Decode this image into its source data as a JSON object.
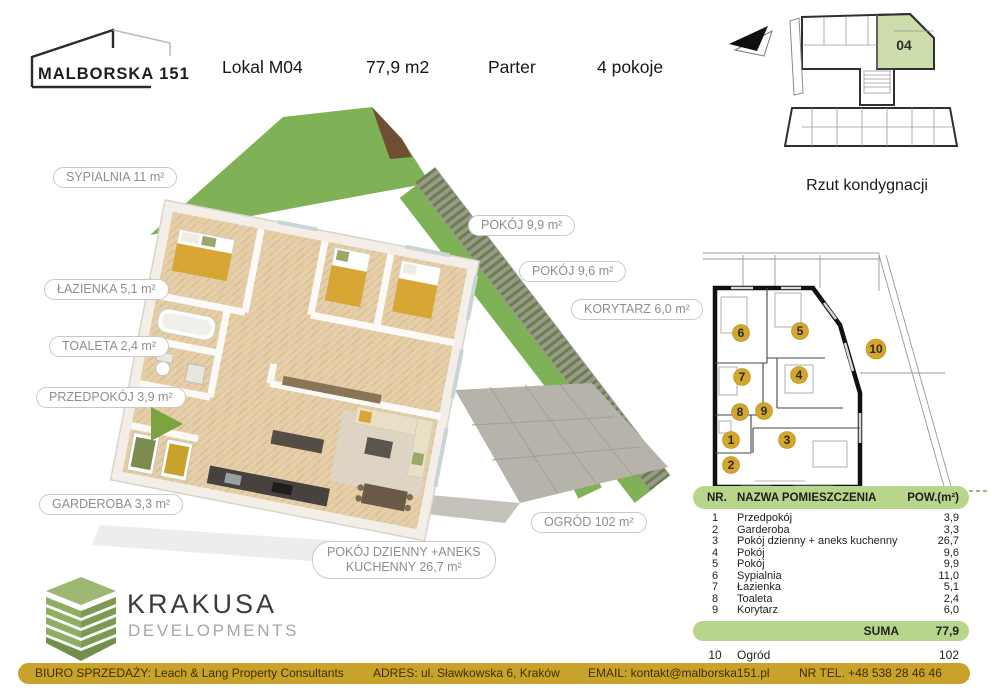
{
  "header": {
    "logo_title": "MALBORSKA 151",
    "items": [
      "Lokal M04",
      "77,9 m2",
      "Parter",
      "4 pokoje"
    ]
  },
  "key_plan": {
    "unit_label": "04",
    "caption": "Rzut kondygnacji"
  },
  "room_labels": {
    "sypialnia": "SYPIALNIA  11 m²",
    "pokoj_99": "POKÓJ  9,9 m²",
    "pokoj_96": "POKÓJ  9,6 m²",
    "korytarz": "KORYTARZ 6,0 m²",
    "lazienka": "ŁAZIENKA 5,1 m²",
    "toaleta": "TOALETA 2,4 m²",
    "przedpokoj": "PRZEDPOKÓJ  3,9 m²",
    "garderoba": "GARDEROBA  3,3 m²",
    "ogrod": "OGRÓD   102 m²",
    "pokoj_dzienny_line1": "POKÓJ DZIENNY +ANEKS",
    "pokoj_dzienny_line2": "KUCHENNY 26,7 m²"
  },
  "plan2d": {
    "markers": [
      "1",
      "2",
      "3",
      "4",
      "5",
      "6",
      "7",
      "8",
      "9",
      "10"
    ]
  },
  "table": {
    "headers": {
      "nr": "NR.",
      "name": "NAZWA POMIESZCZENIA",
      "area": "POW.(m²)"
    },
    "rows": [
      {
        "nr": "1",
        "name": "Przedpokój",
        "area": "3,9"
      },
      {
        "nr": "2",
        "name": "Garderoba",
        "area": "3,3"
      },
      {
        "nr": "3",
        "name": "Pokój dzienny + aneks kuchenny",
        "area": "26,7"
      },
      {
        "nr": "4",
        "name": "Pokój",
        "area": "9,6"
      },
      {
        "nr": "5",
        "name": "Pokój",
        "area": "9,9"
      },
      {
        "nr": "6",
        "name": "Sypialnia",
        "area": "11,0"
      },
      {
        "nr": "7",
        "name": "Łazienka",
        "area": "5,1"
      },
      {
        "nr": "8",
        "name": "Toaleta",
        "area": "2,4"
      },
      {
        "nr": "9",
        "name": "Korytarz",
        "area": "6,0"
      }
    ],
    "suma_label": "SUMA",
    "suma_value": "77,9",
    "extra_row": {
      "nr": "10",
      "name": "Ogród",
      "area": "102"
    }
  },
  "developer": {
    "name": "KRAKUSA",
    "subtitle": "DEVELOPMENTS"
  },
  "footer": {
    "items": [
      "BIURO SPRZEDAŻY: Leach & Lang Property Consultants",
      "ADRES:  ul. Sławkowska 6, Kraków",
      "EMAIL: kontakt@malborska151.pl",
      "NR TEL. +48 538 28 46 46"
    ]
  },
  "colors": {
    "footer_gold": "#c8a22b",
    "table_green": "#b7d68b",
    "unit_highlight_green": "#ccdcaa",
    "marker_gold": "#d3a72e",
    "logo_green": "#8fae63",
    "grass_green": "#7fb257",
    "pointer_green": "#7ca33f",
    "blanket_yellow": "#d8a733"
  }
}
